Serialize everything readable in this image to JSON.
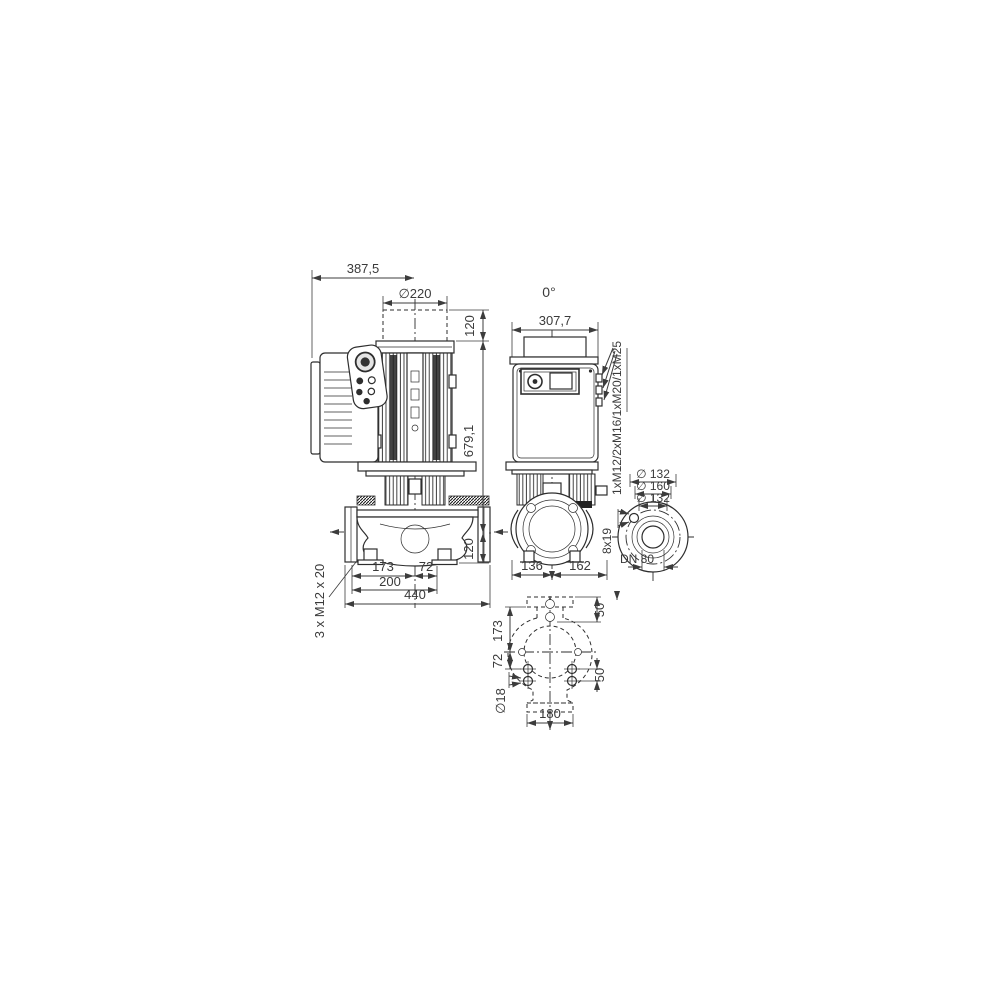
{
  "drawing": {
    "type": "pump-dimensional-drawing",
    "line_color": "#2e2e2e",
    "text_color": "#3a3a3a",
    "background": "#ffffff",
    "front_view": {
      "dim_width_top": "387,5",
      "dim_motor_clearance_dia": "∅220",
      "dim_clearance_height": "120",
      "dim_total_height": "679,1",
      "dim_port_to_base": "120",
      "dim_axis_left": "173",
      "dim_axis_right": "72",
      "dim_foot_span": "200",
      "dim_overall_length": "440",
      "label_foot_thread": "3 x M12 x 20"
    },
    "side_view": {
      "label_orientation": "0°",
      "dim_width": "307,7",
      "dim_bottom_left": "136",
      "dim_bottom_right": "162",
      "label_cable_glands": "1xM12/2xM16/1xM20/1xM25"
    },
    "flange_view": {
      "dim_outer_dia": "∅ 132",
      "dim_bolt_circle_dia": "∅ 160",
      "dim_face_dia": "∅ 132",
      "label_bolt_holes": "8x19",
      "label_nominal_dia": "DN 80"
    },
    "plan_view": {
      "dim_flange_to_axis": "173",
      "dim_axis_to_holes": "72",
      "dim_hole_dia": "∅18",
      "dim_right_top": "50",
      "dim_right_bottom": "50",
      "dim_width": "180"
    }
  }
}
